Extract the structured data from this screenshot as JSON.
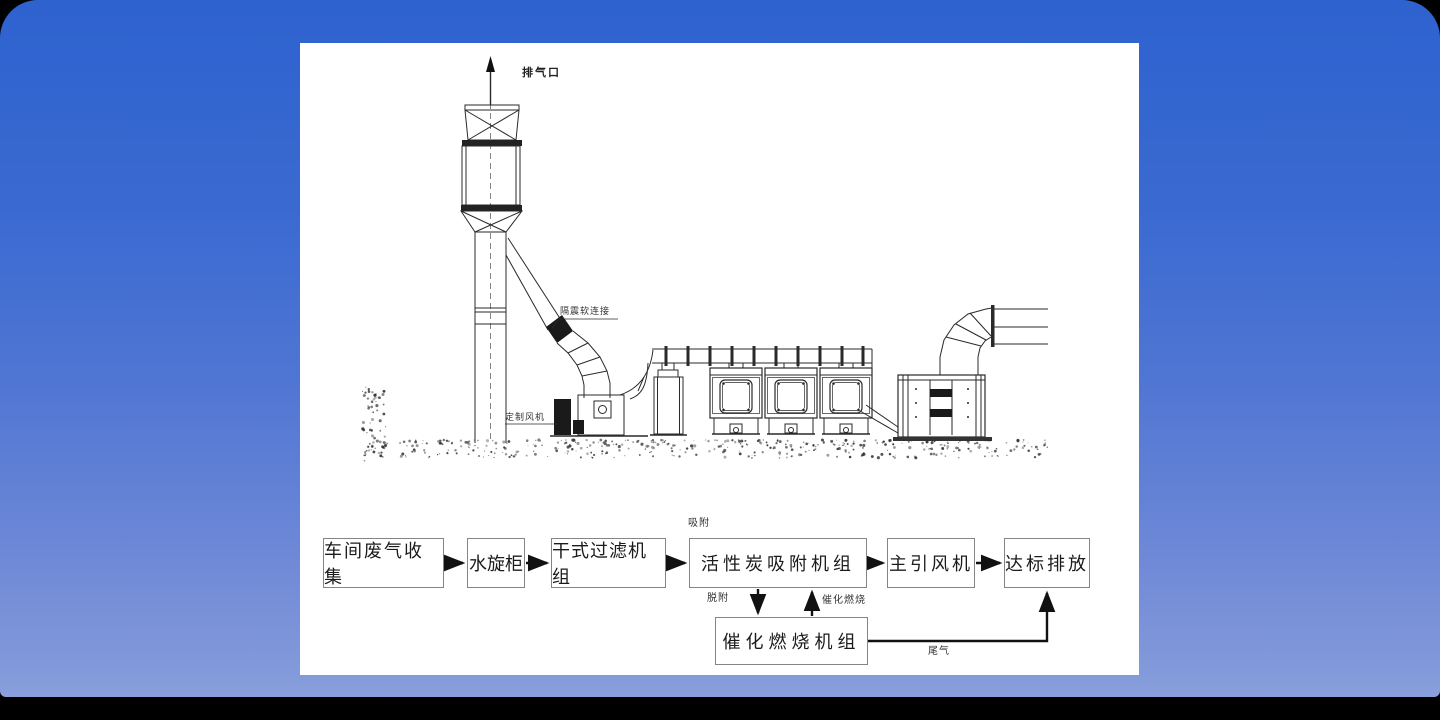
{
  "drawing": {
    "labels": {
      "exhaust_outlet": "排气口",
      "vibration_connector": "隔震软连接",
      "custom_fan": "定制风机"
    }
  },
  "flow": {
    "boxes": [
      {
        "label": "车间废气收集"
      },
      {
        "label": "水旋柜"
      },
      {
        "label": "干式过滤机组"
      },
      {
        "label": "活性炭吸附机组"
      },
      {
        "label": "主引风机"
      },
      {
        "label": "达标排放"
      }
    ],
    "catalytic": {
      "label": "催化燃烧机组"
    },
    "annotations": {
      "adsorb": "吸附",
      "desorb": "脱附",
      "catalytic_burn": "催化燃烧",
      "tail_gas": "尾气"
    }
  },
  "colors": {
    "background_top": "#2e62cf",
    "background_bottom": "#8aa0dc",
    "panel": "#ffffff",
    "line": "#2a2a2a"
  }
}
